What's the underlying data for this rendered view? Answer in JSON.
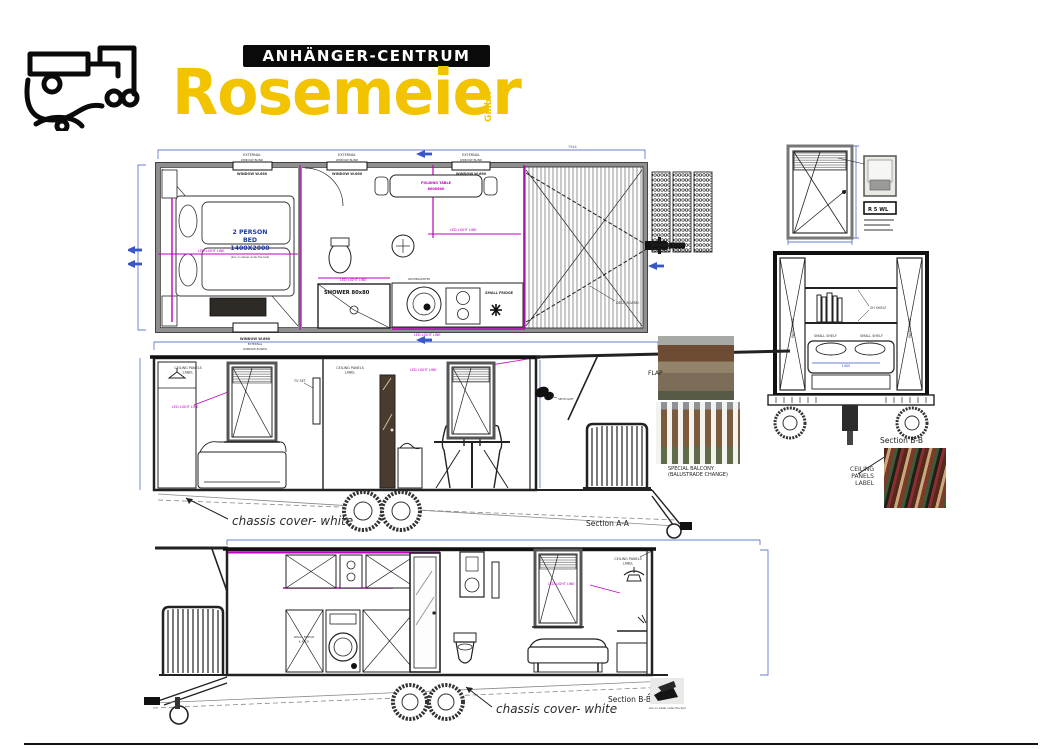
{
  "logo": {
    "top": "ANHÄNGER-CENTRUM",
    "main": "Rosemeier",
    "gmbh": "GmbH"
  },
  "floorplan": {
    "dim_total": "7544",
    "external": "EXTERNAL",
    "window_blind": "WINDOW BLIND",
    "window_blinds": "WINDOW BLINDS",
    "window_label": "WINDOW  W.660",
    "bed_l1": "2 PERSON",
    "bed_l2": "BED",
    "bed_l3": "1400X2000",
    "bed_note": "(box on wheel under the bed)",
    "shower": "SHOWER  80x80",
    "washer": "WASHING/DRYER",
    "fridge": "SMALL FRIDGE",
    "table_l1": "FOLDING TABLE",
    "table_l2": "600X800",
    "deck_board": "DECK BOARD",
    "led": "LED LIGHT LINE"
  },
  "window_detail": {
    "tag": "R 5 WL"
  },
  "section_end": {
    "caption": "Section B-B",
    "shelf": "2H SHELF",
    "small_shelf": "SMALL SHELF",
    "wardrobe": "WARDROBE",
    "dim": "1400"
  },
  "texture": {
    "l1": "CEILING PANELS",
    "l2": "LABEL"
  },
  "section_aa": {
    "caption": "Section A-A",
    "chassis": "chassis cover- white",
    "ceiling_l1": "CEILING PANELS",
    "ceiling_l2": "LABEL",
    "led": "LED LIGHT LINE",
    "tv": "TV SET",
    "spot": "SPOTLIGHT"
  },
  "photos": {
    "flap": "FLAP",
    "balcony_l1": "SPECIAL BALCONY",
    "balcony_l2": "(BALUSTRADE CHANGE)"
  },
  "section_bb": {
    "caption": "Section B-B",
    "chassis": "chassis cover- white",
    "ceiling_l1": "CEILING PANELS",
    "ceiling_l2": "LABEL",
    "led": "LED LIGHT LINE",
    "fridge_l1": "SMALL FRIDGE",
    "fridge_l2": "& RACK",
    "chock": "box on wheel under the bed"
  },
  "colors": {
    "accent_yellow": "#f2c400",
    "dim_blue": "#3a56c5",
    "magenta": "#bf00bf"
  }
}
